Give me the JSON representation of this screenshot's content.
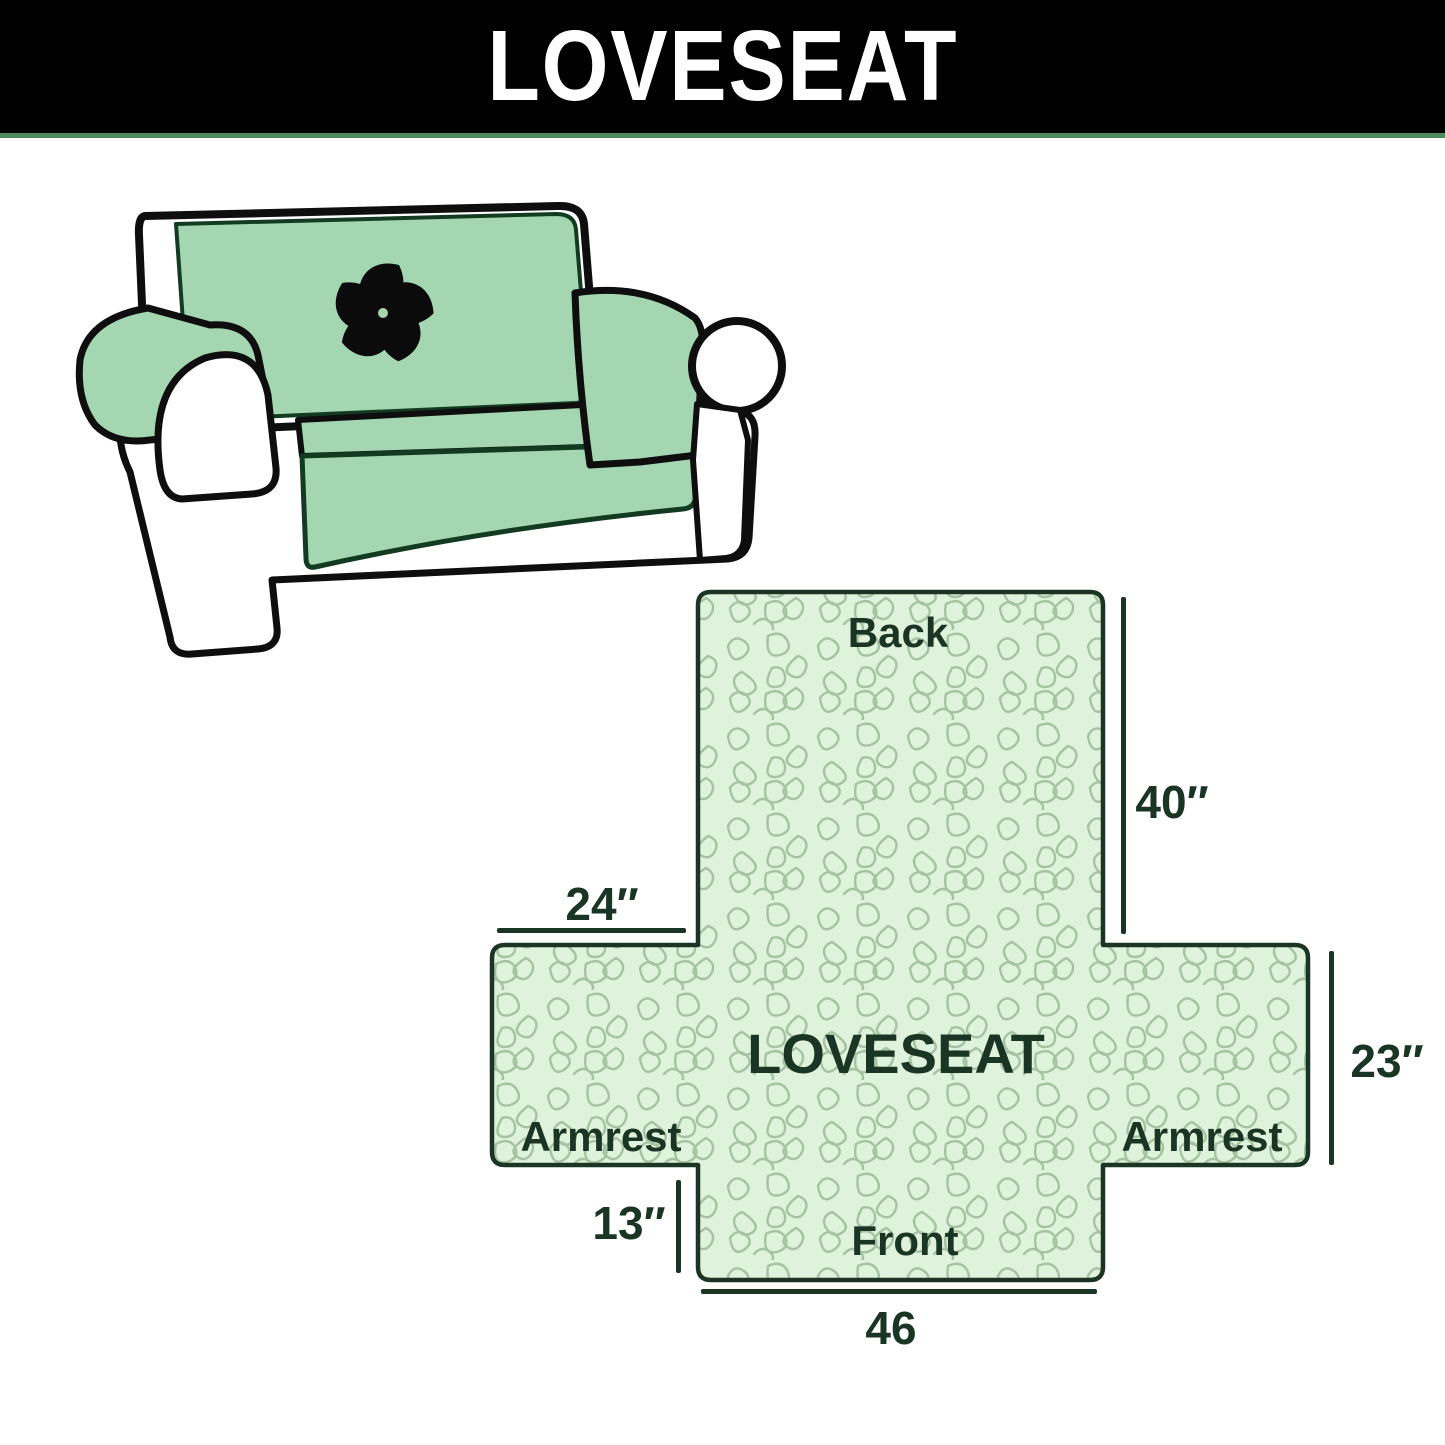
{
  "banner": {
    "title": "LOVESEAT",
    "background_color": "#000000",
    "text_color": "#ffffff",
    "underline_color": "#4e8b5e"
  },
  "illustration": {
    "description": "loveseat sofa with mint green protective cover",
    "logo_icon": "pinwheel-icon",
    "cover_color": "#a4d6b1",
    "outline_color": "#0e0e0e",
    "logo_color": "#0b0b0b"
  },
  "diagram": {
    "back_label": "Back",
    "center_label": "LOVESEAT",
    "front_label": "Front",
    "armrest_left_label": "Armrest",
    "armrest_right_label": "Armrest",
    "dimensions": {
      "back_height": "40″",
      "armrest_width": "24″",
      "armrest_height": "23″",
      "front_skirt_height": "13″",
      "front_width": "46"
    },
    "fill_color": "#dff2dc",
    "pattern_line_color": "#a6c2a2",
    "outline_color": "#1b3524",
    "text_color": "#1b3524"
  }
}
